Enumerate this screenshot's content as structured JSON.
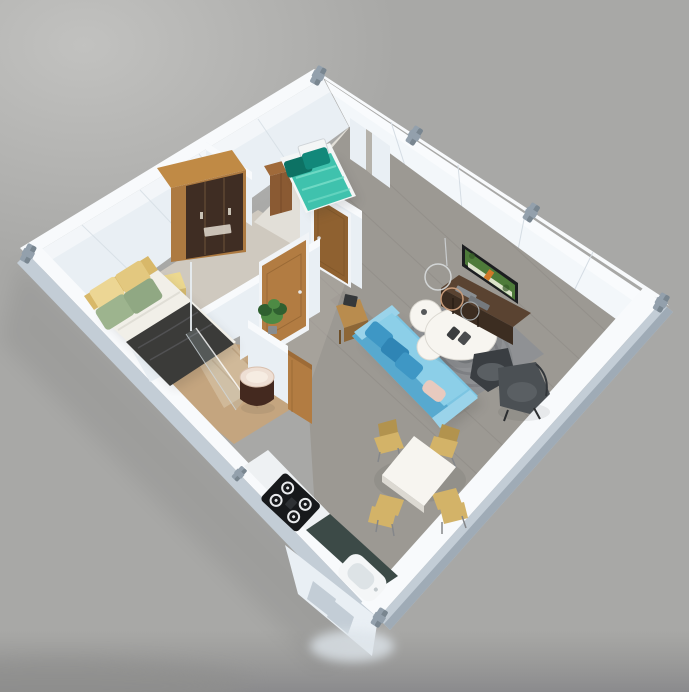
{
  "scene": {
    "description": "3D isometric cutaway render of a compact modular container home floor plan on a plain gray background, viewed from above at an angle",
    "background": "plain gray studio backdrop, lighter at top-left, darker blurred strip at bottom",
    "building": {
      "type": "single-story container home, white panel walls with metal corner clamps",
      "rooms": [
        {
          "name": "master-bedroom",
          "furniture": [
            "double-bed with yellow headboard cushions, sage-green pillows and dark gray blanket",
            "yellow storage bench",
            "dark-brown wardrobe with light wood frame"
          ]
        },
        {
          "name": "small-bedroom",
          "furniture": [
            "single bed with white frame, teal duvet and two dark-teal pillows",
            "brown cabinet"
          ]
        },
        {
          "name": "hallway",
          "furniture": [
            "two wooden interior doors",
            "green potted plant",
            "small wooden side table"
          ]
        },
        {
          "name": "bathroom",
          "furniture": [
            "glass shower screen",
            "round dark pedestal basin",
            "open wooden door"
          ]
        },
        {
          "name": "kitchen",
          "furniture": [
            "white counter with black 4-burner gas cooktop",
            "dark teal countertop",
            "white sink near bottom corner"
          ]
        },
        {
          "name": "living-dining",
          "furniture": [
            "light-blue 3-seat sofa with blue and blush pillows",
            "gray swirl-pattern rug",
            "white round nesting coffee tables",
            "dark-brown TV console with flat-screen TV showing green scene",
            "wire decor lamps",
            "two charcoal armchairs",
            "white square dining table",
            "four light-wood dining chairs",
            "gray wood plank flooring"
          ]
        }
      ]
    }
  },
  "palette": {
    "bg": "#a8a8a6",
    "bg-light": "#c0c0be",
    "bg-dark": "#8f8f8d",
    "wall-top": "#f8fafc",
    "wall-face": "#e9eff4",
    "wall-face-b": "#f3f7fa",
    "wall-outer": "#c3cdd6",
    "wall-outer-dark": "#9fabb6",
    "seam": "#d5dde4",
    "clamp": "#93a0ac",
    "clamp-dark": "#6e7a85",
    "floor-living": "#9c9993",
    "plank-line": "#898680",
    "floor-master": "#cfc9bf",
    "floor-bed2": "#e2dfd8",
    "floor-bath": "#c4a57f",
    "floor-bath-dark": "#ab8a64",
    "door-wood": "#b27c42",
    "door-wood-dark": "#8f6130",
    "door-frame": "#f1f4f7",
    "wardrobe-wood": "#ad7a41",
    "wardrobe-top": "#c08a45",
    "wardrobe-dark": "#3f2d23",
    "label": "#d9d2c6",
    "cabinet-wood": "#8a5a33",
    "bed2-frame": "#f4f6f6",
    "bed2-duvet": "#3fc2ad",
    "bed2-duvet-light": "#7adec9",
    "bed2-pillow": "#0d7264",
    "bed2-pillow2": "#12887a",
    "bed1-mattress": "#f1efe8",
    "bed1-headboard": "#d8b869",
    "bed1-cushion": "#ecd694",
    "bed1-cushion2": "#e3c87f",
    "bed1-pillow": "#9db48e",
    "bed1-pillow2": "#90a883",
    "bed1-blanket": "#3b3b39",
    "bench-yellow": "#ecd88f",
    "bench-side": "#d6ba6e",
    "sofa": "#7cc5e2",
    "sofa-dark": "#57a9cf",
    "sofa-light": "#9ad3ea",
    "sofa-seat": "#8ccfe8",
    "sofa-pillow1": "#3e97c5",
    "sofa-pillow2": "#2f85b5",
    "sofa-pillow-blush": "#e8cabf",
    "rug": "#8f9194",
    "rug-dark": "#6d6f73",
    "table-white": "#f7f5f0",
    "table-shadow": "#dcd9d2",
    "side-table": "#b98c4e",
    "side-table-dark": "#8d6636",
    "console": "#5a4331",
    "console-front": "#3c2d21",
    "tv-frame": "#1c1e20",
    "tv-screen-green": "#4e7b3a",
    "tv-screen-light": "#e8ecd8",
    "tv-accent": "#d07828",
    "chair-dark": "#4b5054",
    "chair-dark2": "#3a3e42",
    "chair-seat": "#5a5f63",
    "dining-chair": "#d3b368",
    "dining-chair-dark": "#b2934e",
    "counter-white": "#eef1f3",
    "counter-teal": "#3c4a47",
    "cooktop": "#17191b",
    "burner": "#e8eaec",
    "sink-white": "#f4f6f7",
    "sink-inner": "#dde3e6",
    "glass": "#cfe2ea",
    "plant": "#4d8a44",
    "plant-dark": "#2f6030",
    "basin-top": "#eedfd4",
    "basin-body": "#44291f"
  }
}
